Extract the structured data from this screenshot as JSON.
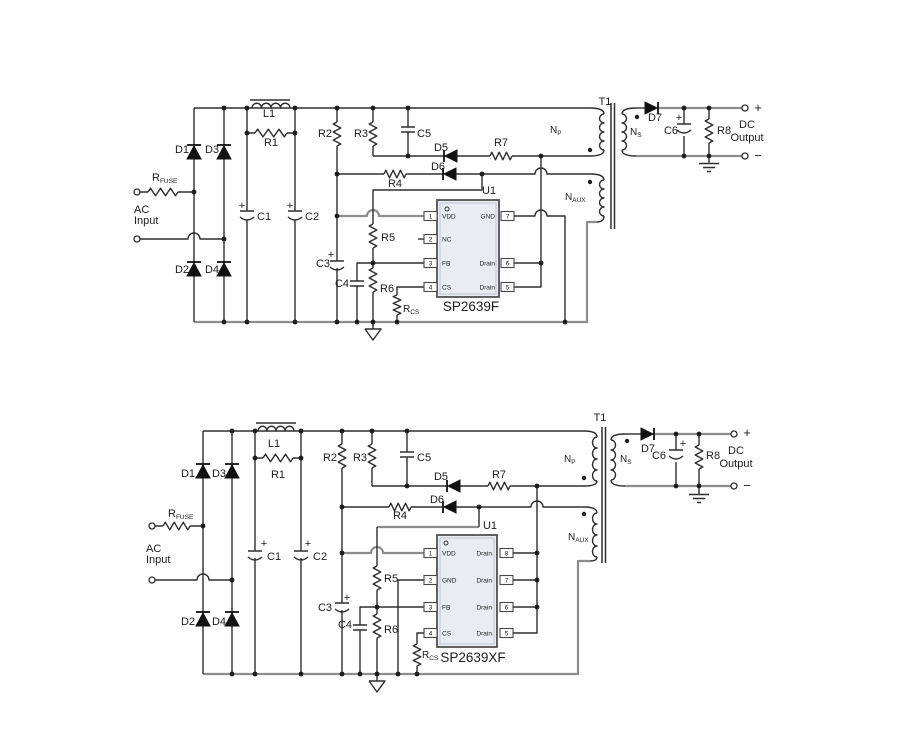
{
  "colors": {
    "background": "#ffffff",
    "wire": "#2e2e2e",
    "bus_wire": "#8d8d8d",
    "ic_fill": "#e9edf3",
    "ic_border": "#474747",
    "text": "#1c1c1c"
  },
  "top_circuit": {
    "input": {
      "ac_line1": "AC",
      "ac_line2": "Input",
      "rfuse_base": "R",
      "rfuse_sub": "FUSE"
    },
    "bridge": {
      "d1": "D1",
      "d2": "D2",
      "d3": "D3",
      "d4": "D4"
    },
    "filter": {
      "l1": "L1",
      "r1": "R1",
      "c1": "C1",
      "c2": "C2",
      "plus": "+"
    },
    "bias": {
      "r2": "R2",
      "r3": "R3",
      "c3": "C3",
      "c4": "C4",
      "c5": "C5",
      "r4": "R4",
      "r5": "R5",
      "r6": "R6",
      "r7": "R7",
      "rcs_base": "R",
      "rcs_sub": "CS",
      "d5": "D5",
      "d6": "D6"
    },
    "ic": {
      "ref": "U1",
      "part": "SP2639F",
      "pins_left": [
        {
          "num": "1",
          "name": "VDD"
        },
        {
          "num": "2",
          "name": "NC"
        },
        {
          "num": "3",
          "name": "FB"
        },
        {
          "num": "4",
          "name": "CS"
        }
      ],
      "pins_right": [
        {
          "num": "7",
          "name": "GND"
        },
        {
          "num": "6",
          "name": "Drain"
        },
        {
          "num": "5",
          "name": "Drain"
        }
      ]
    },
    "transformer": {
      "ref": "T1",
      "np_base": "N",
      "np_sub": "P",
      "ns_base": "N",
      "ns_sub": "S",
      "naux_base": "N",
      "naux_sub": "AUX"
    },
    "output": {
      "d7": "D7",
      "c6": "C6",
      "r8": "R8",
      "plus": "+",
      "minus": "−",
      "dc_line1": "DC",
      "dc_line2": "Output"
    }
  },
  "bottom_circuit": {
    "input": {
      "ac_line1": "AC",
      "ac_line2": "Input",
      "rfuse_base": "R",
      "rfuse_sub": "FUSE"
    },
    "bridge": {
      "d1": "D1",
      "d2": "D2",
      "d3": "D3",
      "d4": "D4"
    },
    "filter": {
      "l1": "L1",
      "r1": "R1",
      "c1": "C1",
      "c2": "C2",
      "plus": "+"
    },
    "bias": {
      "r2": "R2",
      "r3": "R3",
      "c3": "C3",
      "c4": "C4",
      "c5": "C5",
      "r4": "R4",
      "r5": "R5",
      "r6": "R6",
      "r7": "R7",
      "rcs_base": "R",
      "rcs_sub": "CS",
      "d5": "D5",
      "d6": "D6"
    },
    "ic": {
      "ref": "U1",
      "part": "SP2639XF",
      "pins_left": [
        {
          "num": "1",
          "name": "VDD"
        },
        {
          "num": "2",
          "name": "GND"
        },
        {
          "num": "3",
          "name": "FB"
        },
        {
          "num": "4",
          "name": "CS"
        }
      ],
      "pins_right": [
        {
          "num": "8",
          "name": "Drain"
        },
        {
          "num": "7",
          "name": "Drain"
        },
        {
          "num": "6",
          "name": "Drain"
        },
        {
          "num": "5",
          "name": "Drain"
        }
      ]
    },
    "transformer": {
      "ref": "T1",
      "np_base": "N",
      "np_sub": "P",
      "ns_base": "N",
      "ns_sub": "S",
      "naux_base": "N",
      "naux_sub": "AUX"
    },
    "output": {
      "d7": "D7",
      "c6": "C6",
      "r8": "R8",
      "plus": "+",
      "minus": "−",
      "dc_line1": "DC",
      "dc_line2": "Output"
    }
  }
}
